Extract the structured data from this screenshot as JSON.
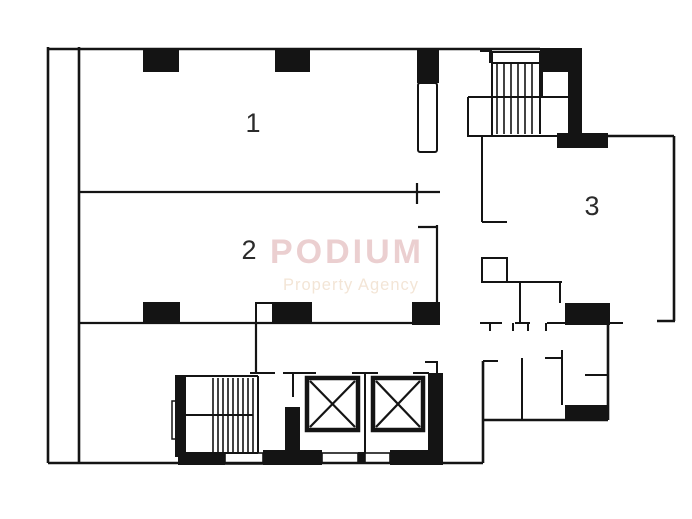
{
  "watermark": {
    "title": "PODIUM",
    "subtitle": "Property Agency",
    "title_color": "#ebcfd0",
    "subtitle_color": "#f3e5d6"
  },
  "rooms": [
    {
      "label": "1"
    },
    {
      "label": "2"
    },
    {
      "label": "3"
    }
  ],
  "colors": {
    "wall": "#141414",
    "background": "#ffffff"
  }
}
